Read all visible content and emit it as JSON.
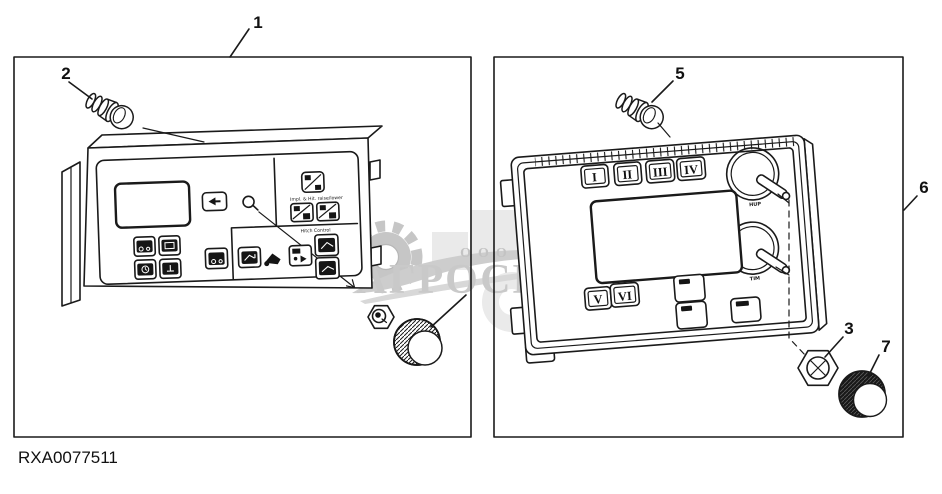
{
  "figure": {
    "code": "RXA0077511"
  },
  "callouts": [
    "1",
    "2",
    "3",
    "5",
    "6",
    "7"
  ],
  "watermark": {
    "prefix": "ООО",
    "name": "АГРОСНАБ",
    "color": "#c9c9c9"
  },
  "left_panel": {
    "labels": {
      "impl_hitch": "Impl. & Hit. raise/lower",
      "hitch_control": "Hitch Control"
    }
  },
  "right_panel": {
    "selector_labels": [
      "I",
      "II",
      "III",
      "IV",
      "V",
      "VI"
    ],
    "knob_labels": [
      "HUP",
      "TIM"
    ]
  },
  "colors": {
    "line": "#1a1a1a",
    "watermark_gray": "#c9c9c9",
    "background": "#ffffff"
  }
}
